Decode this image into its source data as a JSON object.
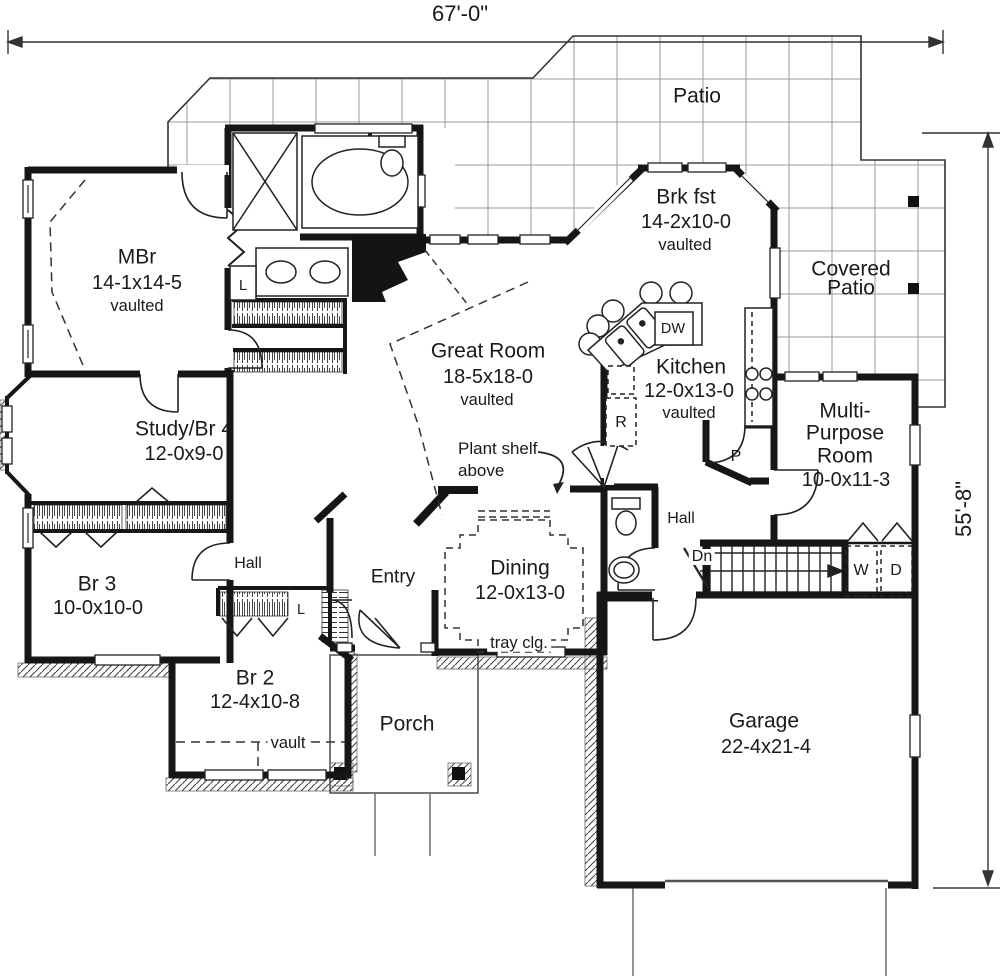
{
  "dimensions": {
    "width_label": "67'-0\"",
    "height_label": "55'-8\""
  },
  "rooms": {
    "patio": {
      "name": "Patio"
    },
    "covered_patio": {
      "line1": "Covered",
      "line2": "Patio"
    },
    "brkfst": {
      "name": "Brk fst",
      "size": "14-2x10-0",
      "note": "vaulted"
    },
    "mbr": {
      "name": "MBr",
      "size": "14-1x14-5",
      "note": "vaulted"
    },
    "great_room": {
      "name": "Great Room",
      "size": "18-5x18-0",
      "note": "vaulted"
    },
    "kitchen": {
      "name": "Kitchen",
      "size": "12-0x13-0",
      "note": "vaulted"
    },
    "multi_purpose": {
      "line1": "Multi-",
      "line2": "Purpose",
      "line3": "Room",
      "size": "10-0x11-3"
    },
    "study": {
      "name": "Study/Br 4",
      "size": "12-0x9-0"
    },
    "br3": {
      "name": "Br 3",
      "size": "10-0x10-0"
    },
    "br2": {
      "name": "Br 2",
      "size": "12-4x10-8",
      "note": "vault"
    },
    "dining": {
      "name": "Dining",
      "size": "12-0x13-0",
      "note": "tray clg."
    },
    "entry": {
      "name": "Entry"
    },
    "porch": {
      "name": "Porch"
    },
    "garage": {
      "name": "Garage",
      "size": "22-4x21-4"
    },
    "hall_left": {
      "name": "Hall"
    },
    "hall_right": {
      "name": "Hall"
    }
  },
  "annotations": {
    "plant_shelf_line1": "Plant shelf",
    "plant_shelf_line2": "above",
    "stairs_down": "Dn"
  },
  "fixtures": {
    "dishwasher": "DW",
    "range": "R",
    "pantry": "P",
    "linen_bath": "L",
    "linen_entry": "L",
    "washer": "W",
    "dryer": "D"
  }
}
